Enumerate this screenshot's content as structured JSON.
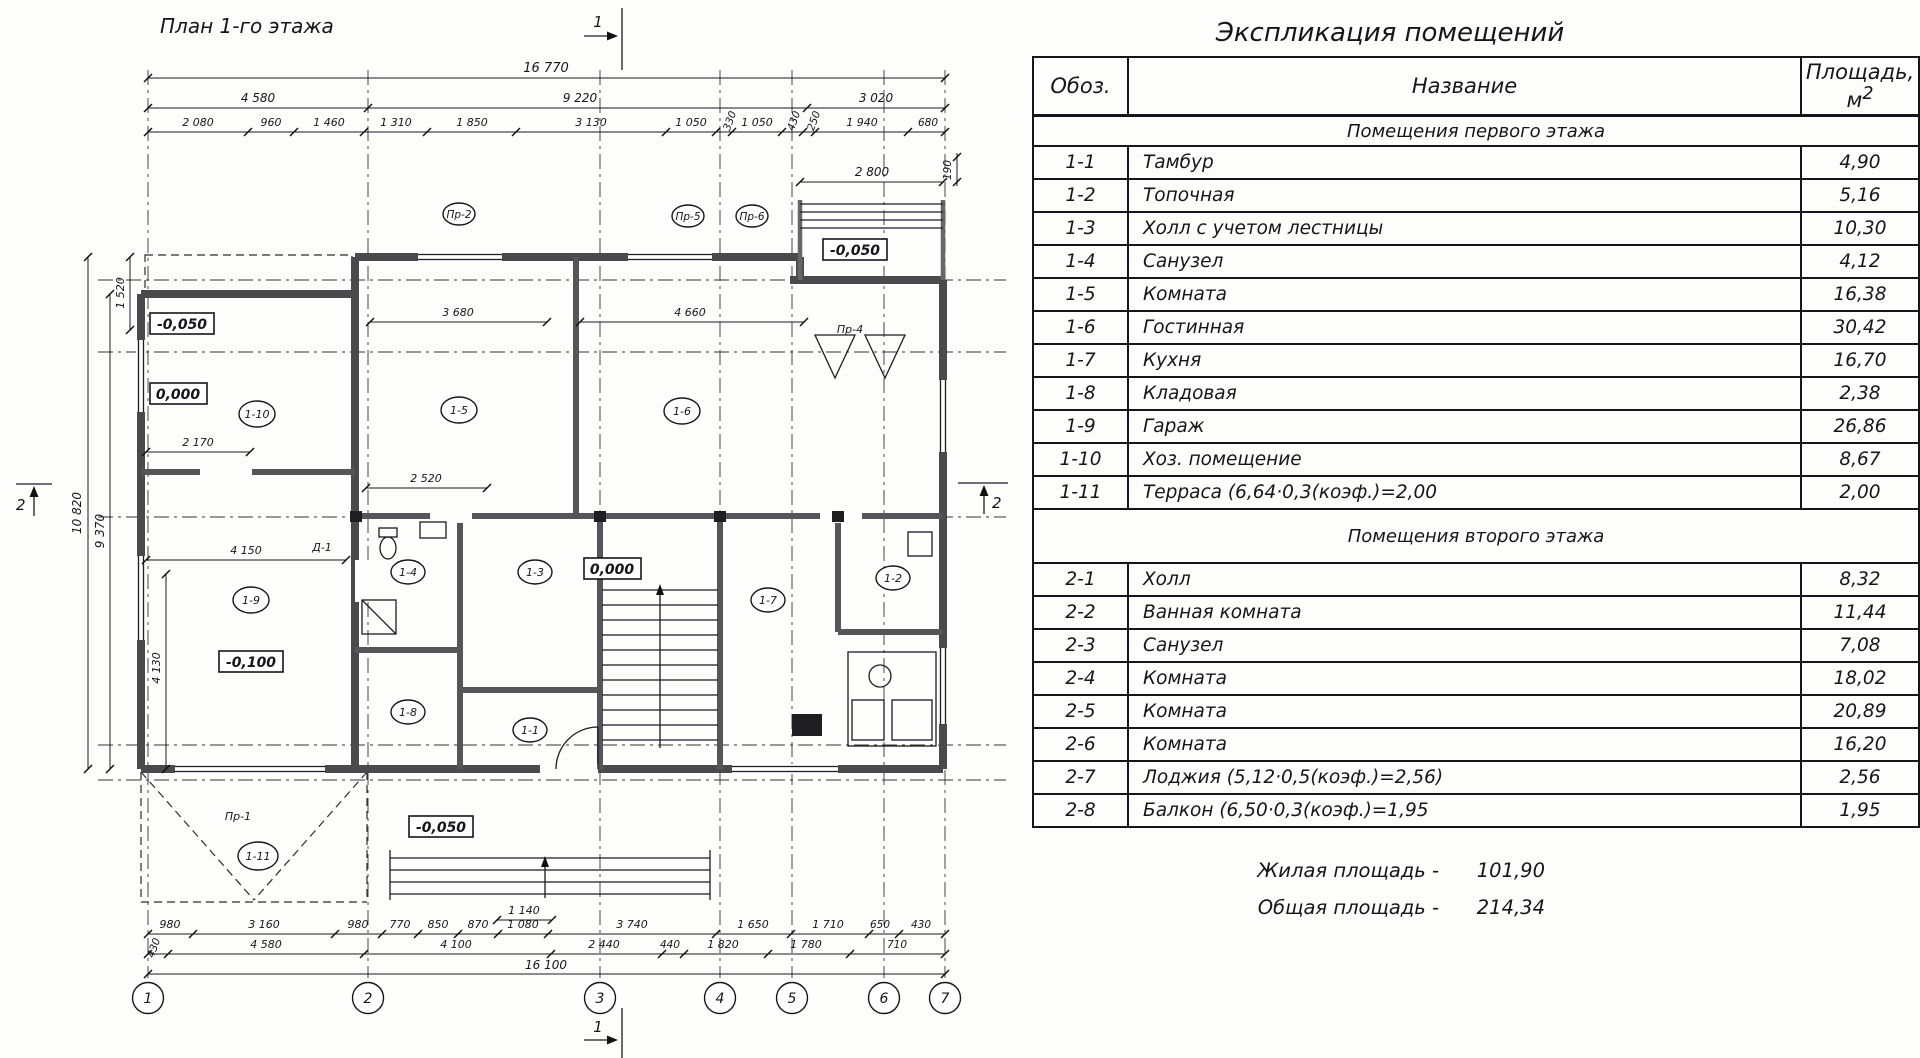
{
  "plan": {
    "title": "План 1-го этажа",
    "section_mark": "1",
    "section_mark2": "2",
    "axes_bottom": [
      "1",
      "2",
      "3",
      "4",
      "5",
      "6",
      "7"
    ],
    "axes_right": [
      "Д",
      "Г",
      "В",
      "Б",
      "А"
    ],
    "rooms": [
      "1-10",
      "1-5",
      "1-6",
      "1-9",
      "1-4",
      "1-3",
      "1-7",
      "1-2",
      "1-1",
      "1-8",
      "1-11"
    ],
    "elevations": {
      "e1": "-0,050",
      "e2": "0,000",
      "e3": "-0,100",
      "e4": "0,000",
      "e5": "-0,050",
      "e6": "-0,050"
    },
    "tags": {
      "t1": "Пр-1",
      "t2": "Пр-2",
      "t3": "Пр-4",
      "t4": "Пр-5",
      "t5": "Пр-6",
      "t6": "Д-1"
    },
    "dims": {
      "top_overall": "16 770",
      "top_row2": [
        "4 580",
        "9 220",
        "3 020"
      ],
      "top_row3": [
        "2 080",
        "960",
        "1 460",
        "1 310",
        "1 850",
        "3 130",
        "1 050",
        "330",
        "1 050",
        "430",
        "250",
        "1 940",
        "680"
      ],
      "top_right": "2 800",
      "top_right2": "190",
      "left": [
        "1 520",
        "10 820",
        "9 370",
        "4 130"
      ],
      "right": [
        "7 720",
        "1 595",
        "3 460",
        "4 680"
      ],
      "inner": [
        "3 680",
        "4 660",
        "2 170",
        "2 520",
        "4 150",
        "1 140"
      ],
      "bottom_row1": [
        "980",
        "3 160",
        "980",
        "770",
        "850",
        "870",
        "1 080",
        "3 740",
        "1 650",
        "1 710",
        "650",
        "430"
      ],
      "bottom_row2": [
        "430",
        "4 580",
        "4 100",
        "2 440",
        "440",
        "1 820",
        "1 780",
        "710"
      ],
      "bottom_overall": "16 100"
    }
  },
  "table": {
    "title": "Экспликация помещений",
    "col_code": "Обоз.",
    "col_name": "Название",
    "col_area": "Площадь,",
    "col_area_unit": "м",
    "col_area_sup": "2",
    "section1": "Помещения первого этажа",
    "section2": "Помещения второго этажа",
    "rows1": [
      {
        "code": "1-1",
        "name": "Тамбур",
        "area": "4,90"
      },
      {
        "code": "1-2",
        "name": "Топочная",
        "area": "5,16"
      },
      {
        "code": "1-3",
        "name": "Холл с учетом лестницы",
        "area": "10,30"
      },
      {
        "code": "1-4",
        "name": "Санузел",
        "area": "4,12"
      },
      {
        "code": "1-5",
        "name": "Комната",
        "area": "16,38"
      },
      {
        "code": "1-6",
        "name": "Гостинная",
        "area": "30,42"
      },
      {
        "code": "1-7",
        "name": "Кухня",
        "area": "16,70"
      },
      {
        "code": "1-8",
        "name": "Кладовая",
        "area": "2,38"
      },
      {
        "code": "1-9",
        "name": "Гараж",
        "area": "26,86"
      },
      {
        "code": "1-10",
        "name": "Хоз. помещение",
        "area": "8,67"
      },
      {
        "code": "1-11",
        "name": "Терраса (6,64·0,3(коэф.)=2,00",
        "area": "2,00"
      }
    ],
    "rows2": [
      {
        "code": "2-1",
        "name": "Холл",
        "area": "8,32"
      },
      {
        "code": "2-2",
        "name": "Ванная комната",
        "area": "11,44"
      },
      {
        "code": "2-3",
        "name": "Санузел",
        "area": "7,08"
      },
      {
        "code": "2-4",
        "name": "Комната",
        "area": "18,02"
      },
      {
        "code": "2-5",
        "name": "Комната",
        "area": "20,89"
      },
      {
        "code": "2-6",
        "name": "Комната",
        "area": "16,20"
      },
      {
        "code": "2-7",
        "name": "Лоджия (5,12·0,5(коэф.)=2,56)",
        "area": "2,56"
      },
      {
        "code": "2-8",
        "name": "Балкон (6,50·0,3(коэф.)=1,95",
        "area": "1,95"
      }
    ],
    "total1_label": "Жилая площадь -",
    "total1_value": "101,90",
    "total2_label": "Общая площадь -",
    "total2_value": "214,34"
  }
}
